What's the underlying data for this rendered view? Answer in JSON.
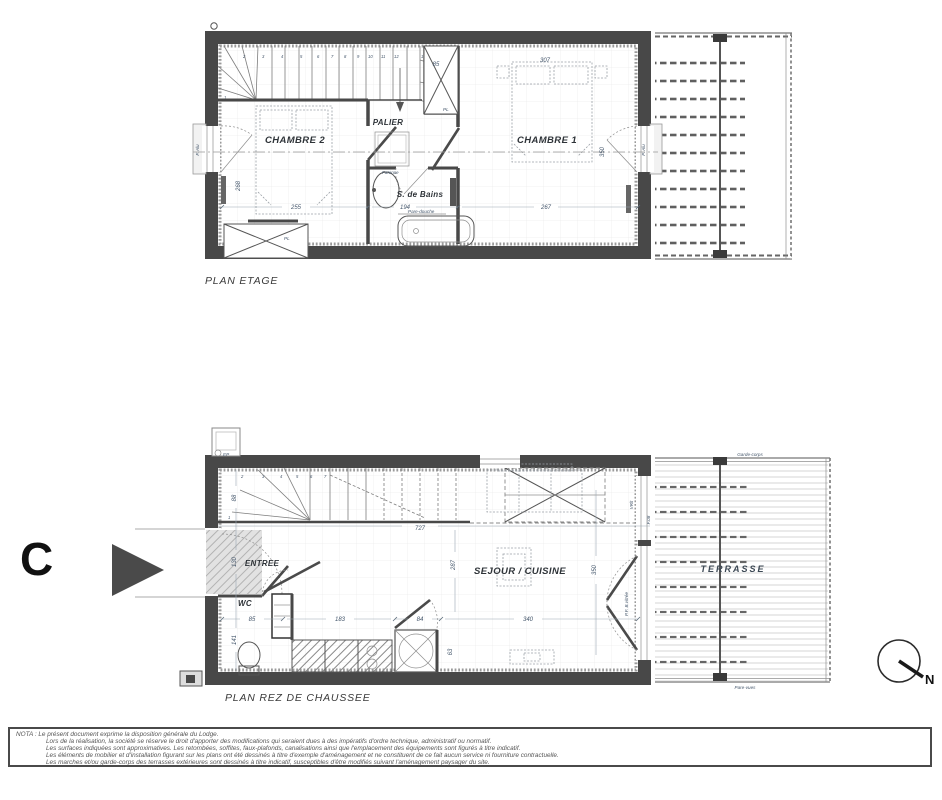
{
  "titles": {
    "plan_etage": "PLAN ETAGE",
    "plan_rdc": "PLAN REZ DE CHAUSSEE"
  },
  "marker": {
    "letter": "C"
  },
  "compass": {
    "north": "N"
  },
  "colors": {
    "wall": "#484848",
    "dim_text": "#44566b",
    "room_text": "#2e3338"
  },
  "upper": {
    "rooms": {
      "chambre2": "CHAMBRE 2",
      "palier": "PALIER",
      "sdb": "S. de Bains",
      "chambre1": "CHAMBRE 1"
    },
    "labels": {
      "pl": "PL",
      "pare_douche": "Pare-douche",
      "faience": "Faïence",
      "window_left": "F. Alu",
      "window_right": "P. Alu"
    },
    "dims": {
      "w_chambre2": "255",
      "w_sdb": "194",
      "w_chambre1": "267",
      "w_bed1": "307",
      "h_chambre1": "350",
      "h_chambre2": "268",
      "w_pl": "85"
    },
    "stairs": [
      "1",
      "2",
      "3",
      "4",
      "5",
      "6",
      "7",
      "8",
      "9",
      "10",
      "11",
      "12",
      "13",
      "14",
      "15"
    ]
  },
  "ground": {
    "rooms": {
      "entree": "ENTREE",
      "wc": "WC",
      "sejour": "SEJOUR / CUISINE",
      "terrasse": "TERRASSE"
    },
    "labels": {
      "ep": "EP",
      "garde_corps": "Garde-corps",
      "pare_vues": "Pare-vues",
      "baie": "P.F. B.vitrée",
      "f08": "F.08",
      "vrlt": "VRlt"
    },
    "dims": {
      "stair_w": "88",
      "entree_h": "130",
      "wc_h": "141",
      "wc_w": "85",
      "kitchen_w": "183",
      "cellier_w": "84",
      "total_w": "727",
      "sejour_h": "287",
      "sejour_w": "340",
      "tv_h": "63",
      "baie_h": "350"
    },
    "stairs": [
      "1",
      "2",
      "3",
      "4",
      "5",
      "6",
      "7"
    ]
  },
  "nota": {
    "lines": [
      "NOTA : Le présent document exprime la disposition générale du Lodge.",
      "Lors de la réalisation, la société se réserve le droit d'apporter des modifications qui seraient dues à des impératifs d'ordre technique, administratif ou normatif.",
      "Les surfaces indiquées sont approximatives. Les retombées, soffites, faux-plafonds, canalisations ainsi que l'emplacement des équipements sont figurés à titre indicatif.",
      "Les éléments de mobilier et d'installation figurant sur les plans ont été dessinés à titre d'exemple d'aménagement et ne constituent de ce fait aucun service ni fourniture contractuelle.",
      "Les marches et/ou garde-corps des terrasses extérieures sont dessinés à titre indicatif, susceptibles d'être modifiés suivant l'aménagement paysager du site."
    ]
  }
}
